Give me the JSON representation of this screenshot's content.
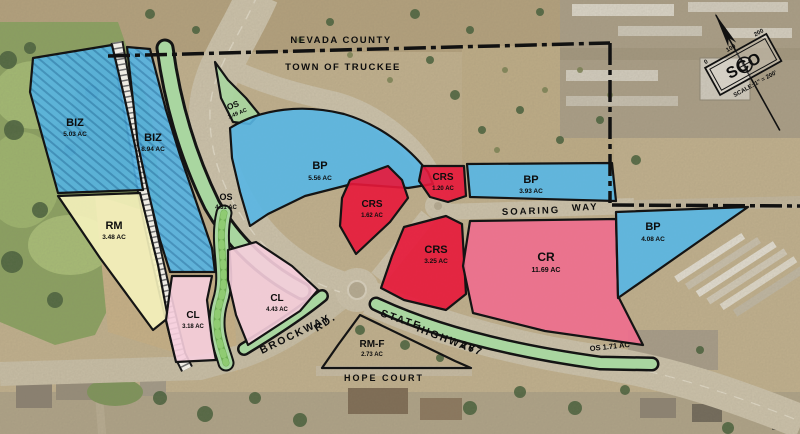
{
  "map_title": "Joerger Ranch zoning site plan",
  "boundary": {
    "north_label": "NEVADA COUNTY",
    "south_label": "TOWN OF TRUCKEE"
  },
  "parcels": [
    {
      "name": "BIZ",
      "acres": "5.03 AC"
    },
    {
      "name": "BIZ",
      "acres": "8.94 AC"
    },
    {
      "name": "RM",
      "acres": "3.48 AC"
    },
    {
      "name": "OS",
      "acres": "1.49 AC"
    },
    {
      "name": "OS",
      "acres": "4.31 AC"
    },
    {
      "name": "BP",
      "acres": "5.56 AC"
    },
    {
      "name": "CRS",
      "acres": "1.62 AC"
    },
    {
      "name": "CRS",
      "acres": "1.20 AC"
    },
    {
      "name": "BP",
      "acres": "3.93 AC"
    },
    {
      "name": "CRS",
      "acres": "3.25 AC"
    },
    {
      "name": "CR",
      "acres": "11.69 AC"
    },
    {
      "name": "BP",
      "acres": "4.08 AC"
    },
    {
      "name": "CL",
      "acres": "3.18 AC"
    },
    {
      "name": "CL",
      "acres": "4.43 AC"
    },
    {
      "name": "RM-F",
      "acres": "2.73 AC"
    },
    {
      "name": "OS",
      "acres": "1.71 AC",
      "label": "OS 1.71 AC"
    }
  ],
  "roads": {
    "brockway": "BROCKWAY",
    "brockway_suffix": "RD.",
    "highway_1": "STATE",
    "highway_2": "HIGHWAY",
    "highway_3": "267",
    "hope": "HOPE COURT",
    "soaring_1": "SOARING",
    "soaring_2": "WAY"
  },
  "map_scale": {
    "tick_0": "0",
    "tick_1": "100",
    "tick_2": "200",
    "logo": "SCO",
    "text": "SCALE: 1\" = 200'"
  },
  "colors": {
    "biz_bp_blue": "#58b6e4",
    "crs_red": "#e8173a",
    "cr_rose": "#ef6d8e",
    "cl_pink": "#f6cedd",
    "rm_yellow": "#f5f2bc",
    "os_green": "#a9d6a0",
    "outline": "#141414"
  }
}
